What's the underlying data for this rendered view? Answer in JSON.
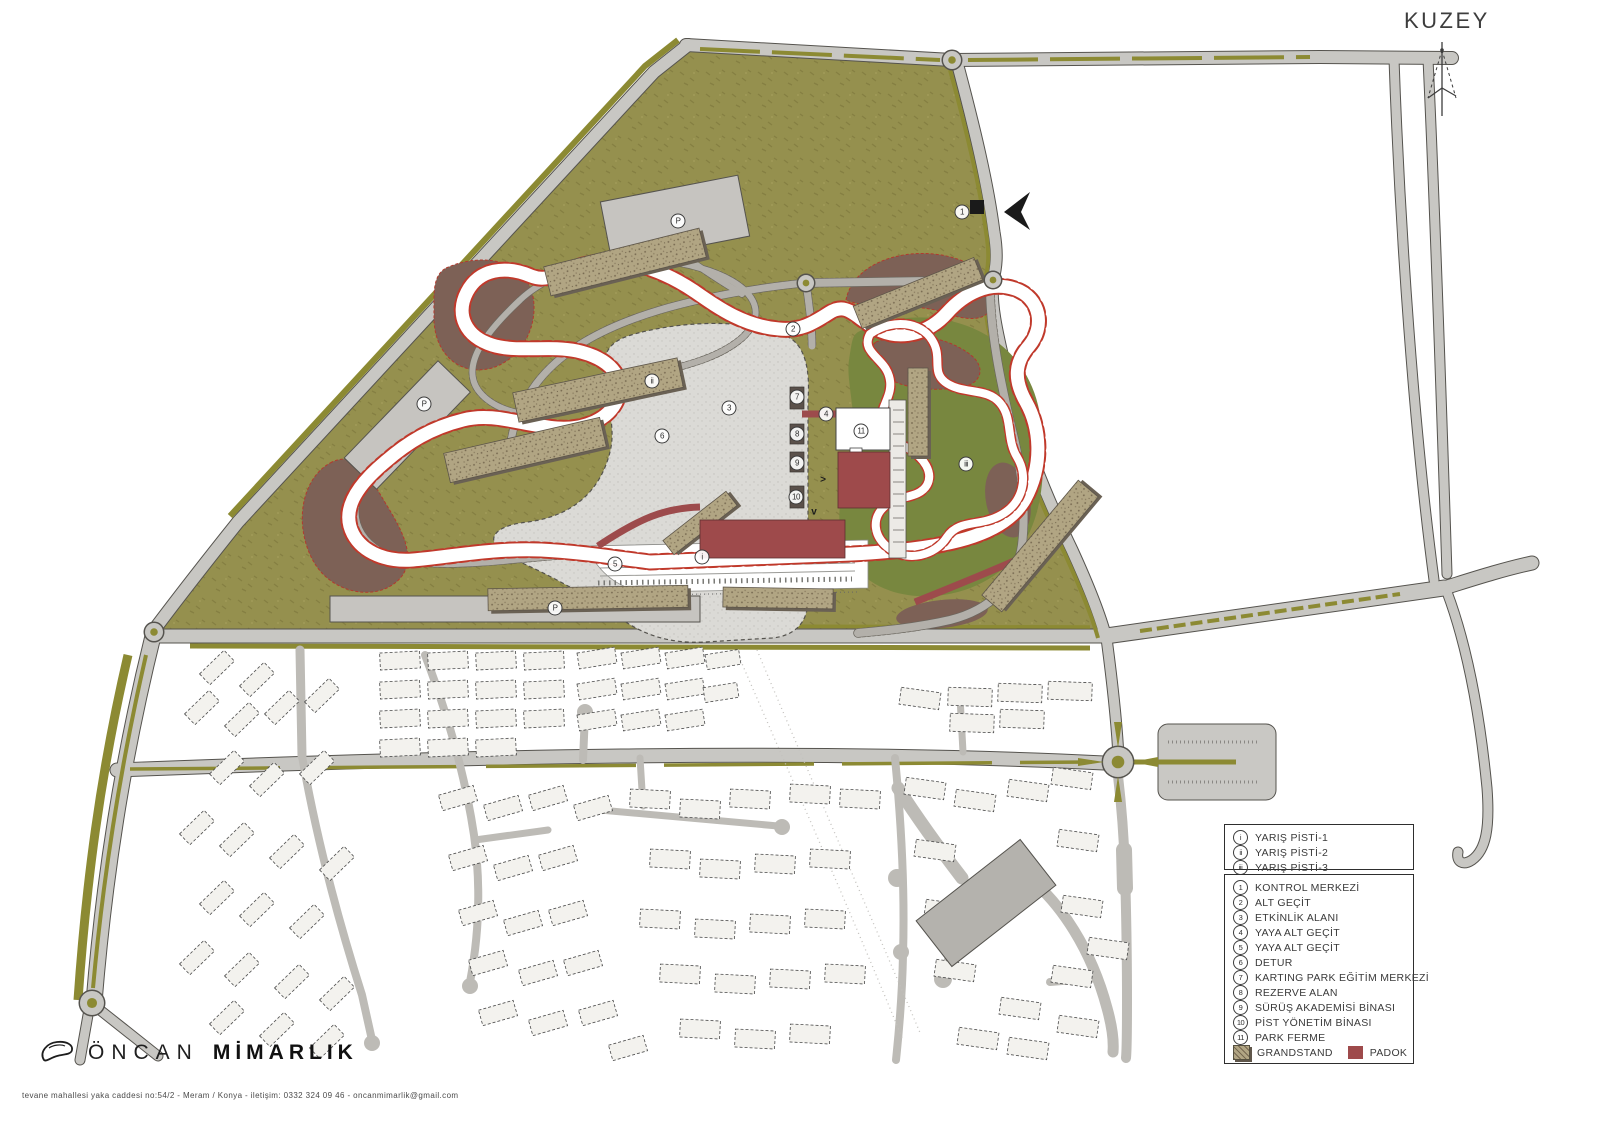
{
  "map": {
    "north_label": "KUZEY",
    "parking_label": "P",
    "arrows": {
      "right": ">",
      "down": "v"
    },
    "markers": [
      {
        "label": "1"
      },
      {
        "label": "2"
      },
      {
        "label": "3"
      },
      {
        "label": "4"
      },
      {
        "label": "5"
      },
      {
        "label": "6"
      },
      {
        "label": "7"
      },
      {
        "label": "8"
      },
      {
        "label": "9"
      },
      {
        "label": "10"
      },
      {
        "label": "11"
      },
      {
        "label": "i"
      },
      {
        "label": "ii"
      },
      {
        "label": "iii"
      }
    ],
    "colors": {
      "site_green": "#95904E",
      "karting_green": "#78873F",
      "road_gray": "#C8C7C3",
      "median_olive": "#8C8A33",
      "runoff_brown": "#7D6156",
      "track_white": "#FFFFFF",
      "curb_red": "#C0392B",
      "grandstand_tan": "#B1A583",
      "padok_red": "#9E4A4B",
      "plaza_gray": "#DBDAD6",
      "building_white": "#F3F2EE"
    }
  },
  "legend": {
    "tracks": [
      {
        "num": "i",
        "label": "YARIŞ PİSTİ-1"
      },
      {
        "num": "ii",
        "label": "YARIŞ PİSTİ-2"
      },
      {
        "num": "iii",
        "label": "YARIŞ PİSTİ-3"
      }
    ],
    "items": [
      {
        "num": "1",
        "label": "KONTROL  MERKEZİ"
      },
      {
        "num": "2",
        "label": "ALT GEÇİT"
      },
      {
        "num": "3",
        "label": "ETKİNLİK ALANI"
      },
      {
        "num": "4",
        "label": "YAYA ALT GEÇİT"
      },
      {
        "num": "5",
        "label": "YAYA ALT GEÇİT"
      },
      {
        "num": "6",
        "label": "DETUR"
      },
      {
        "num": "7",
        "label": "KARTING PARK EĞİTİM MERKEZİ"
      },
      {
        "num": "8",
        "label": "REZERVE ALAN"
      },
      {
        "num": "9",
        "label": "SÜRÜŞ AKADEMİSİ BİNASI"
      },
      {
        "num": "10",
        "label": "PİST YÖNETİM BİNASI"
      },
      {
        "num": "11",
        "label": "PARK FERME"
      }
    ],
    "swatches": [
      {
        "label": "GRANDSTAND"
      },
      {
        "label": "PADOK"
      }
    ]
  },
  "footer": {
    "brand_light": "ÖNCAN",
    "brand_bold": "MİMARLIK",
    "address": "tevane mahallesi yaka caddesi no:54/2 - Meram / Konya - iletişim: 0332 324 09 46 - oncanmimarlik@gmail.com"
  }
}
